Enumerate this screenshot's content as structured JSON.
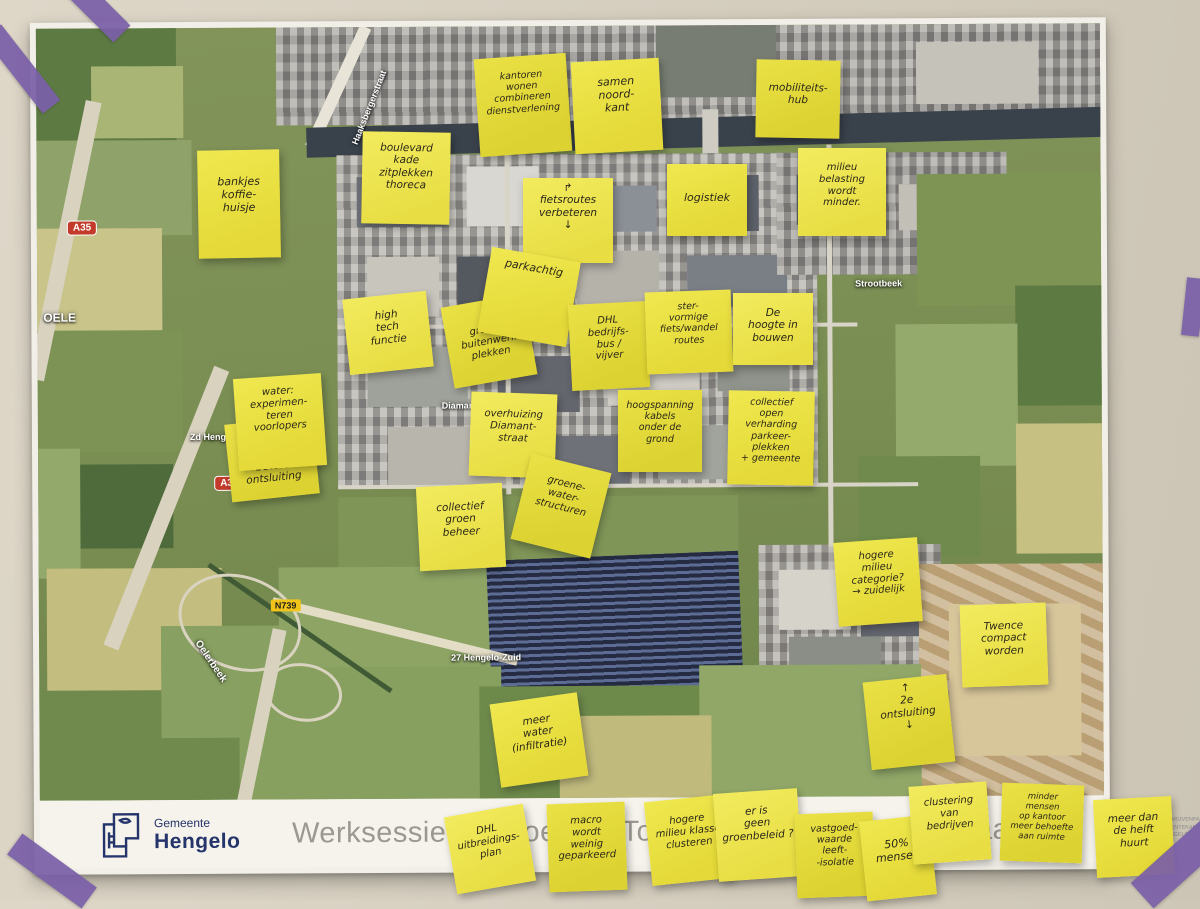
{
  "poster": {
    "title": "Werksessie vergroening Toekomstbeeld Twentekanaal",
    "municipality_logo": {
      "small": "Gemeente",
      "large": "Hengelo"
    },
    "partner_logo_text": "BEDRIJVENPARK\nTWENTEKANAAL\nHENGELO"
  },
  "map_labels": [
    {
      "id": "haaksbergerstraat",
      "text": "Haaksbergerstraat"
    },
    {
      "id": "oele",
      "text": "OELE"
    },
    {
      "id": "a35-north",
      "text": "A35"
    },
    {
      "id": "a35-south",
      "text": "A35"
    },
    {
      "id": "n739",
      "text": "N739"
    },
    {
      "id": "oelerbeek",
      "text": "Oelerbeek"
    },
    {
      "id": "strootbeek",
      "text": "Strootbeek"
    },
    {
      "id": "diamantstraat",
      "text": "Diamantstraat"
    },
    {
      "id": "zd-hengelo",
      "text": "Zd Hengelo"
    },
    {
      "id": "hengelo-zuid",
      "text": "27 Hengelo-Zuid"
    }
  ],
  "sticky_notes": [
    {
      "id": "bankjes",
      "text": "bankjes\nkoffie-\nhuisje"
    },
    {
      "id": "boulevard",
      "text": "boulevard\nkade\nzitplekken\nthoreca"
    },
    {
      "id": "kantoren",
      "text": "kantoren\nwonen\ncombineren\ndienstverlening"
    },
    {
      "id": "samen-noordkant",
      "text": "samen\nnoord-\nkant"
    },
    {
      "id": "fietsroutes",
      "text": "↱\nfietsroutes\nverbeteren\n↓"
    },
    {
      "id": "mobiliteitshub",
      "text": "mobiliteits-\nhub"
    },
    {
      "id": "logistiek",
      "text": "logistiek"
    },
    {
      "id": "milieubelasting",
      "text": "milieu\nbelasting\nwordt\nminder."
    },
    {
      "id": "groene-buitenwerkplekken",
      "text": "groene\nbuitenwerk\nplekken"
    },
    {
      "id": "parkachtig",
      "text": "parkachtig"
    },
    {
      "id": "hightech",
      "text": "high\ntech\nfunctie"
    },
    {
      "id": "dhl-bedrijfsbus",
      "text": "DHL\nbedrijfs-\nbus /\nvijver"
    },
    {
      "id": "stervormige-routes",
      "text": "ster-\nvormige\nfiets/wandel\nroutes"
    },
    {
      "id": "hoogte-in-bouwen",
      "text": "De\nhoogte in\nbouwen"
    },
    {
      "id": "betere-ontsluiting",
      "text": "betere\nontsluiting"
    },
    {
      "id": "water-experimenteren",
      "text": "water:\nexperimen-\nteren\nvoorlopers"
    },
    {
      "id": "overhuizing-diamantstraat",
      "text": "overhuizing\nDiamant-\nstraat"
    },
    {
      "id": "hoogspanning",
      "text": "hoogspanning\nkabels\nonder de\ngrond"
    },
    {
      "id": "collectief-verharding",
      "text": "collectief\nopen\nverharding\nparkeer-\nplekken\n+ gemeente"
    },
    {
      "id": "collectief-groenbeheer",
      "text": "collectief\ngroen\nbeheer"
    },
    {
      "id": "groene-waterstructuren",
      "text": "groene-\nwater-\nstructuren"
    },
    {
      "id": "hogere-milieucategorie",
      "text": "hogere\nmilieu\ncategorie?\n→ zuidelijk"
    },
    {
      "id": "twence-compact",
      "text": "Twence\ncompact\nworden"
    },
    {
      "id": "tweede-ontsluiting",
      "text": "↑\n2e\nontsluiting\n↓"
    },
    {
      "id": "meer-water-infiltratie",
      "text": "meer\nwater\n(infiltratie)"
    },
    {
      "id": "dhl-uitbreidingsplan",
      "text": "DHL\nuitbreidings-\nplan"
    },
    {
      "id": "macro-geparkeerd",
      "text": "macro\nwordt\nweinig\ngeparkeerd"
    },
    {
      "id": "hogere-milieuklasse",
      "text": "hogere\nmilieu klasse\nclusteren"
    },
    {
      "id": "geen-groenbeleid",
      "text": "er is\ngeen\ngroenbeleid ?"
    },
    {
      "id": "vastgoedwaarde",
      "text": "vastgoed-\nwaarde\nleeft-\n-isolatie"
    },
    {
      "id": "vijftig-procent",
      "text": "50%\nmensen"
    },
    {
      "id": "clustering-bedrijven",
      "text": "clustering\nvan\nbedrijven"
    },
    {
      "id": "minder-mensen-kantoor",
      "text": "minder\nmensen\nop kantoor\nmeer behoefte\naan ruimte"
    },
    {
      "id": "meer-dan-helft-huurt",
      "text": "meer dan\nde helft\nhuurt"
    }
  ],
  "colors": {
    "note_yellow": "#ece24b",
    "tape_purple": "#7a5fa8",
    "municipality_blue": "#25356b",
    "partner_teal": "#49b8cc",
    "canal_dark": "#39414b"
  }
}
